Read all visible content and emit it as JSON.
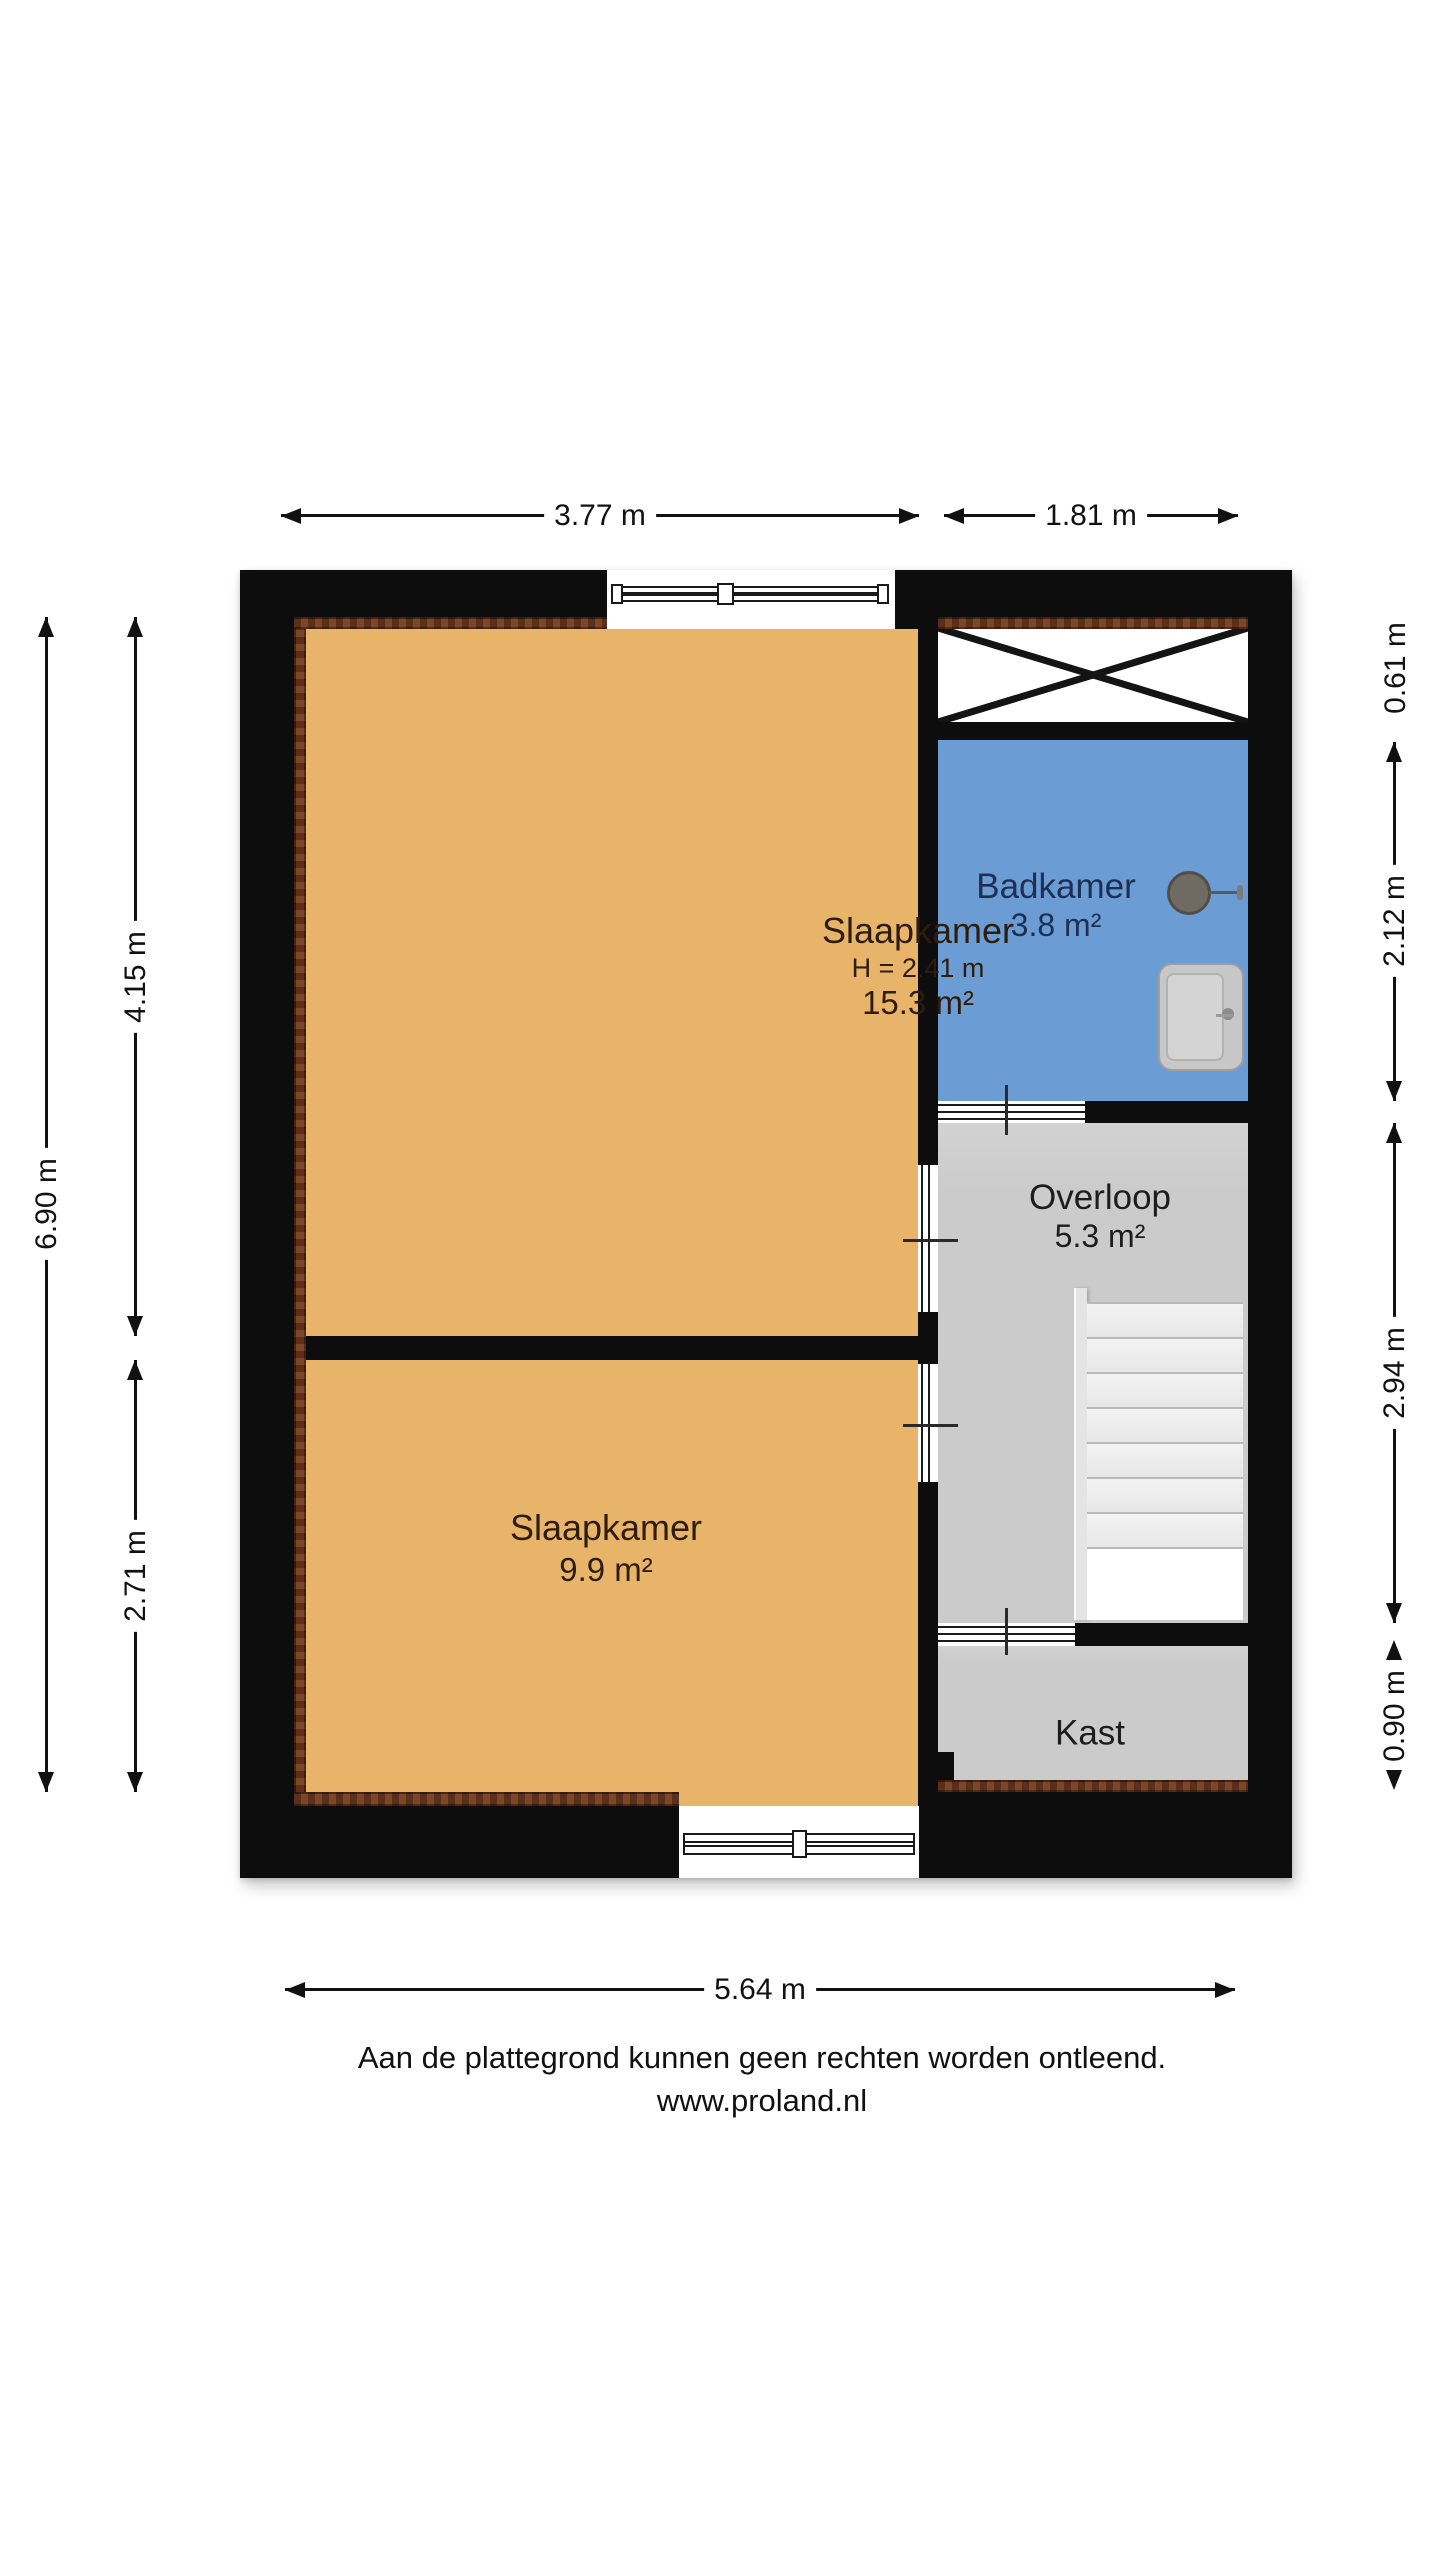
{
  "rooms": {
    "slaapkamer1": {
      "name": "Slaapkamer",
      "ceiling_height": "H = 2.41 m",
      "area": "15.3 m²"
    },
    "slaapkamer2": {
      "name": "Slaapkamer",
      "area": "9.9 m²"
    },
    "badkamer": {
      "name": "Badkamer",
      "area": "3.8 m²"
    },
    "overloop": {
      "name": "Overloop",
      "area": "5.3 m²"
    },
    "kast": {
      "name": "Kast"
    }
  },
  "dimensions": {
    "top": [
      "3.77 m",
      "1.81 m"
    ],
    "bottom": [
      "5.64 m"
    ],
    "left_outer": [
      "6.90 m"
    ],
    "left_inner": [
      "4.15 m",
      "2.71 m"
    ],
    "right": [
      "0.61 m",
      "2.12 m",
      "2.94 m",
      "0.90 m"
    ]
  },
  "footer": {
    "disclaimer": "Aan de plattegrond kunnen geen rechten worden ontleend.",
    "website": "www.proland.nl"
  },
  "fixtures": {
    "sink": "sink-icon",
    "shower": "shower-tray-icon",
    "stairs": "staircase",
    "cross": "low-headroom-cross-icon"
  },
  "colors": {
    "wall": "#0d0d0d",
    "room-orange": "#e8b469",
    "room-blue": "#6b9cd3",
    "room-gray": "#cbcbcb",
    "hatch-dark": "#5c2f1b",
    "hatch-light": "#7c4627",
    "text-bedroom": "#2e1d0d",
    "text-bathroom": "#1d3054",
    "text-grayroom": "#1d1d1d",
    "dim": "#111111"
  }
}
